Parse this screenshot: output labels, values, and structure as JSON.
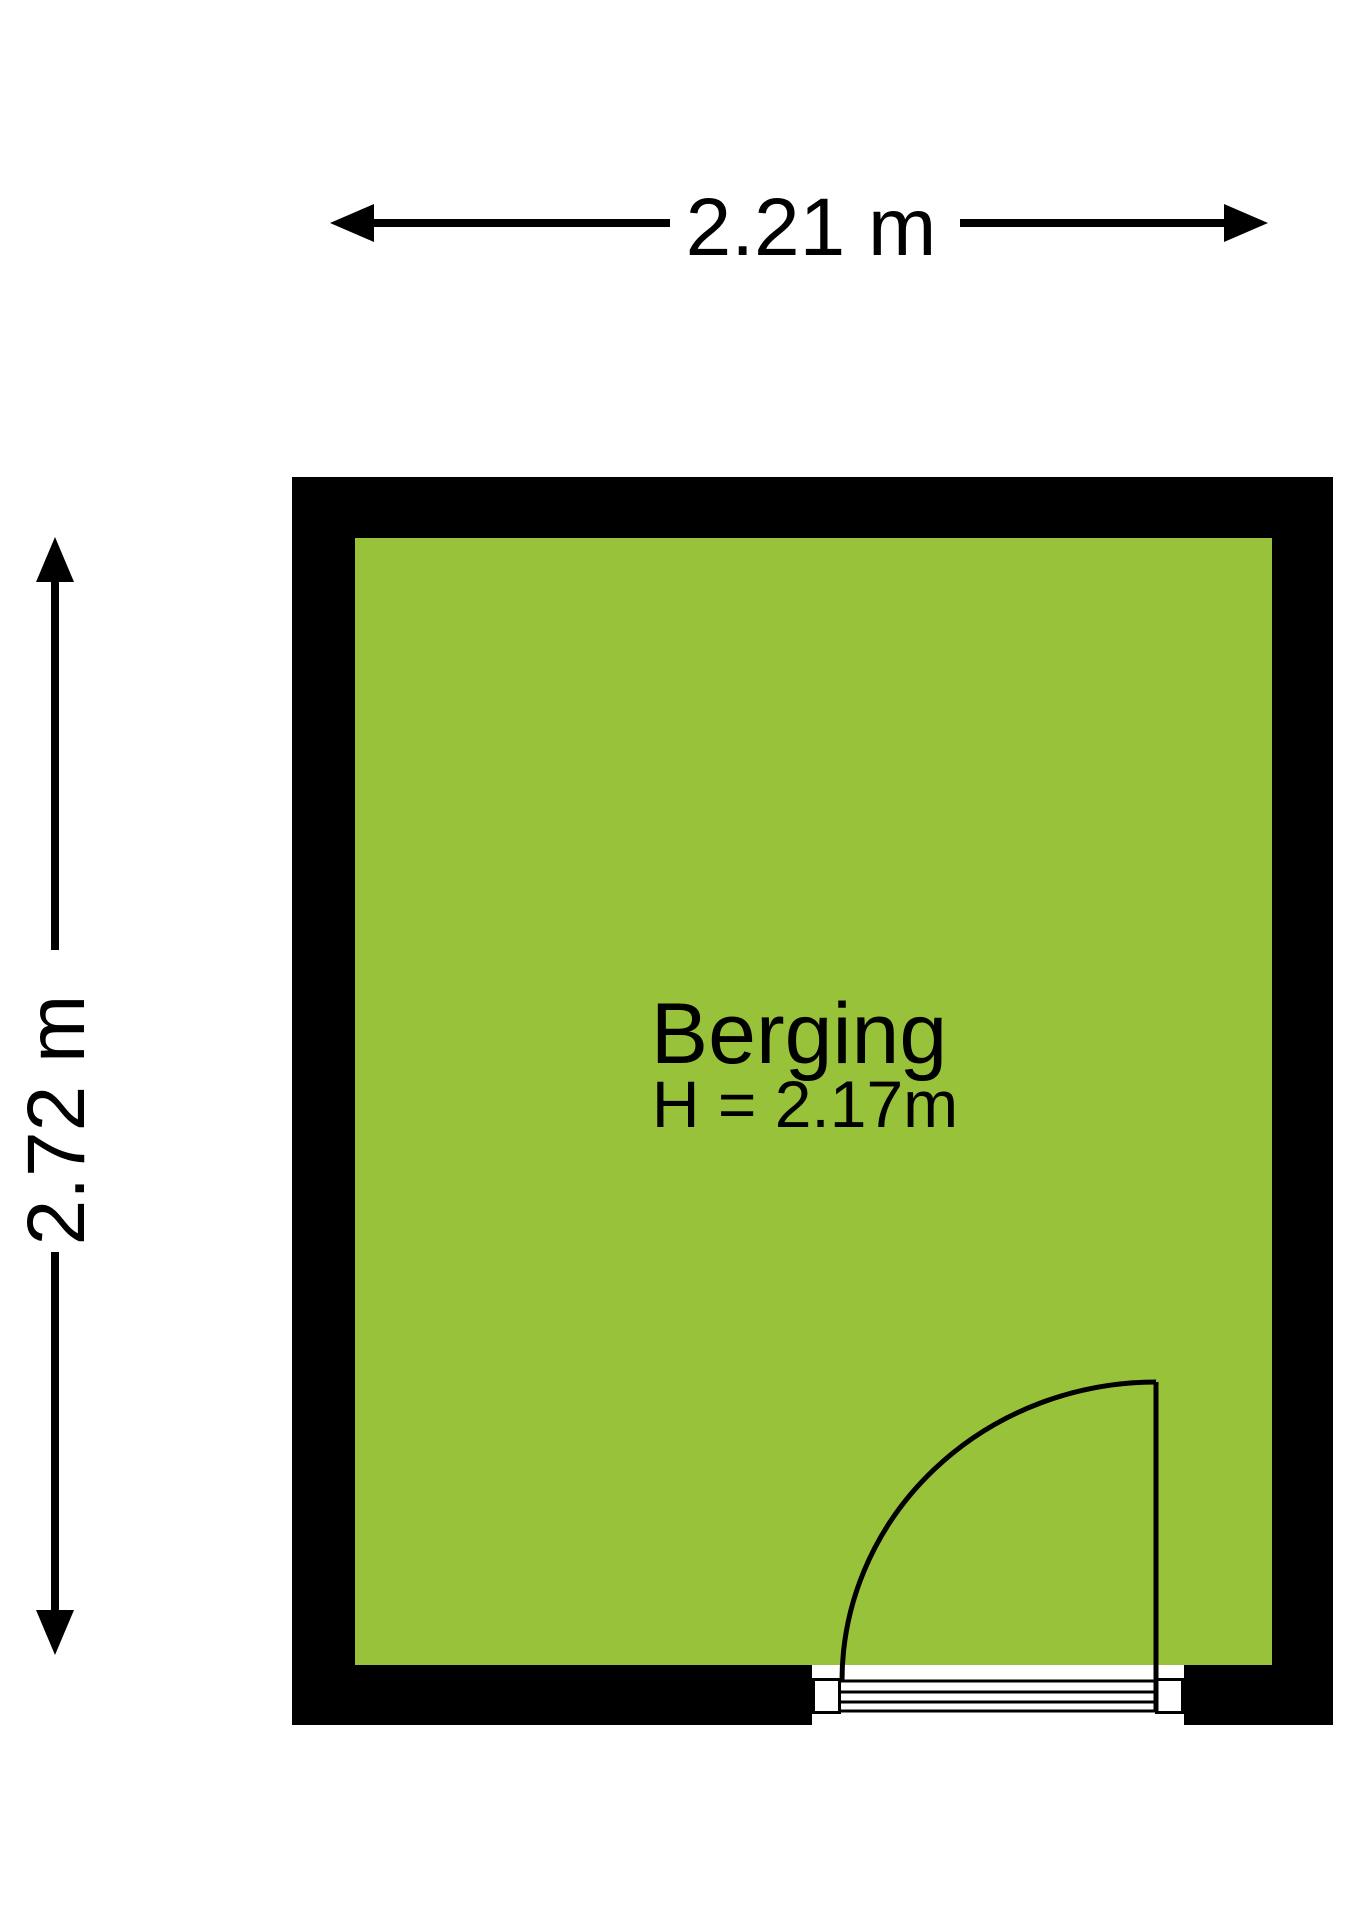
{
  "room": {
    "name": "Berging",
    "ceiling_height_label": "H = 2.17m",
    "floor_color": "#99c23b",
    "wall_color": "#000000",
    "line_color": "#000000",
    "door_fill_color": "#ffffff"
  },
  "dimensions": {
    "width_label": "2.21 m",
    "height_label": "2.72 m"
  }
}
